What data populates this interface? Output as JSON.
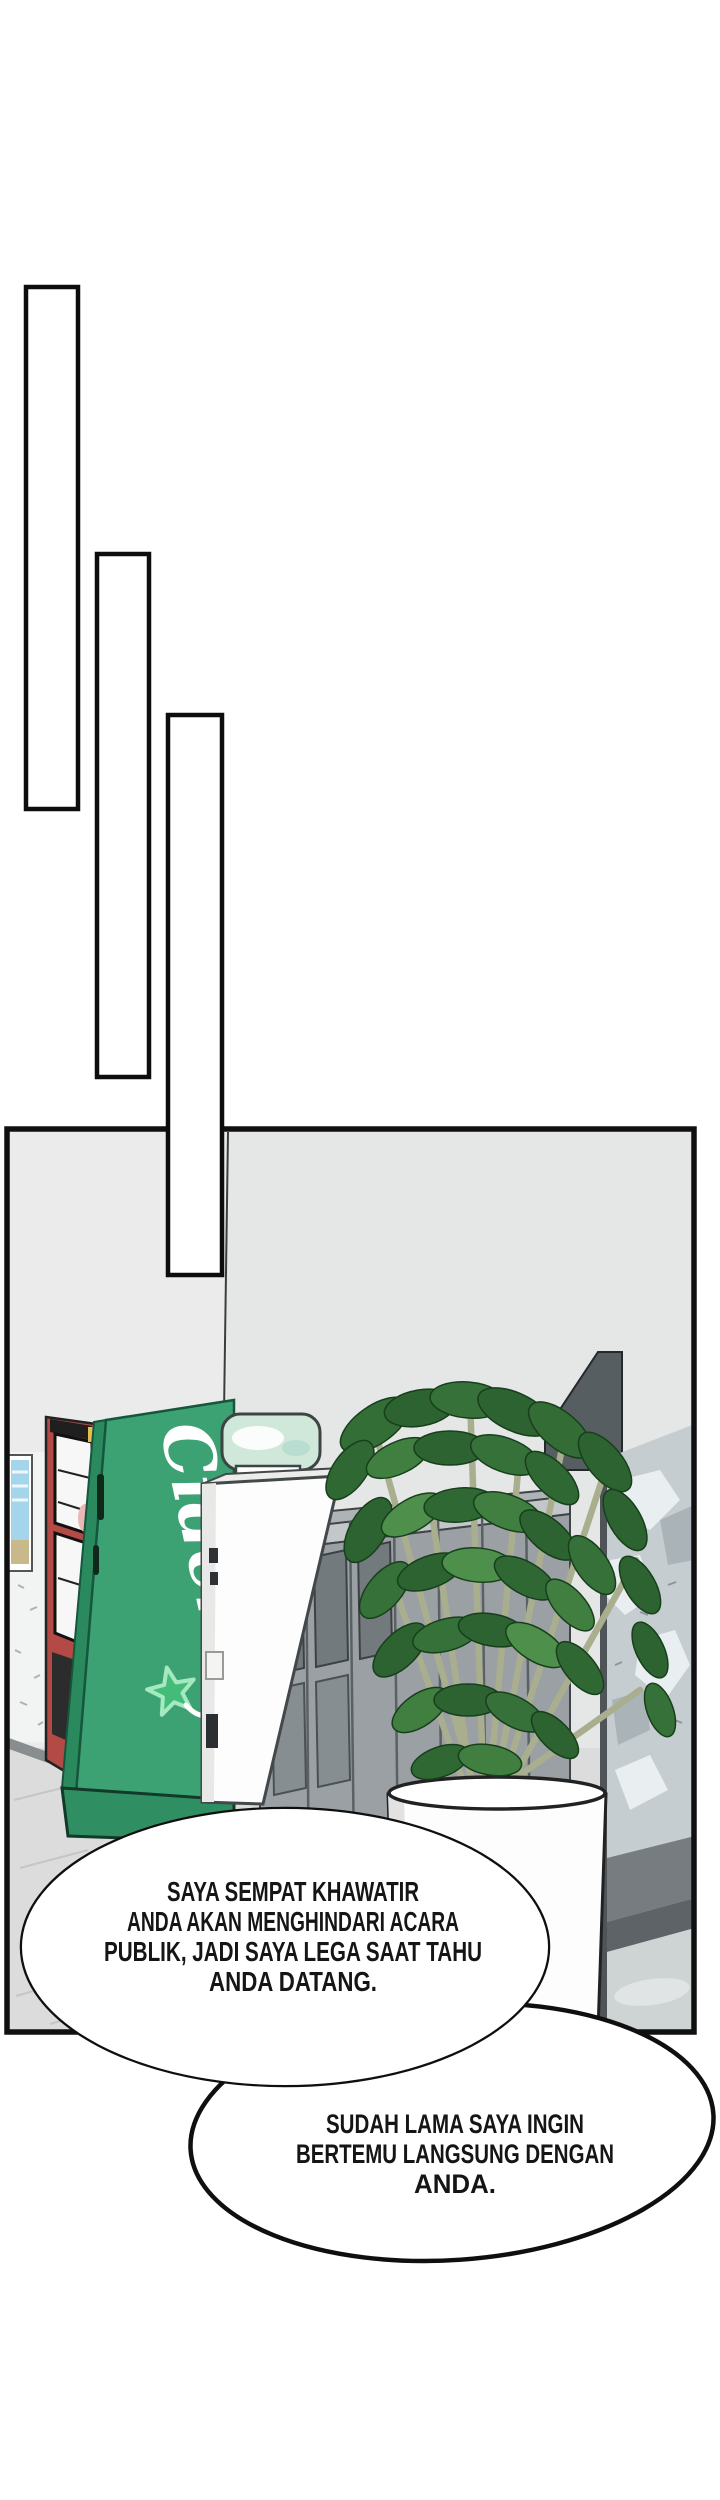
{
  "speech": {
    "bubble1": {
      "lines": [
        "SAYA SEMPAT KHAWATIR",
        "ANDA AKAN MENGHINDARI ACARA",
        "PUBLIK, JADI SAYA LEGA SAAT TAHU",
        "ANDA DATANG."
      ]
    },
    "bubble2": {
      "lines": [
        "SUDAH LAMA SAYA INGIN",
        "BERTEMU LANGSUNG DENGAN",
        "ANDA."
      ]
    }
  },
  "scene": {
    "vending_machine_brand": "Cider",
    "colors": {
      "vending_green": "#3ca273",
      "vending_green_side": "#2a8a5e",
      "vending_red": "#b34a45",
      "star_green": "#43bb79",
      "bottle_teal": "#cfe8da",
      "locker_gray": "#9aa0a3",
      "concrete_gray": "#c6cdd0",
      "wall_gray": "#e5e6e6",
      "panel_border": "#101010"
    }
  }
}
